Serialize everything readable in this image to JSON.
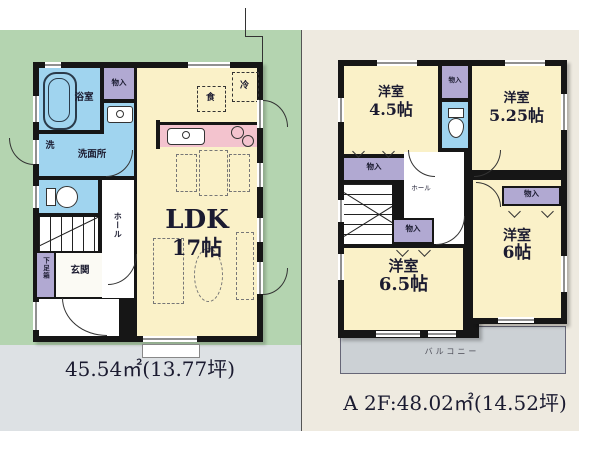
{
  "floor1": {
    "area_text": "45.54㎡(13.77坪)",
    "ldk_name": "LDK",
    "ldk_size": "17帖",
    "labels": {
      "bathroom": "浴室",
      "storage": "物入",
      "washer": "洗",
      "washroom": "洗面所",
      "shoe_cabinet": "下足箱",
      "entrance": "玄関",
      "hall": "ホール",
      "fridge": "冷",
      "cupboard": "食"
    }
  },
  "floor2": {
    "area_text": "A 2F:48.02㎡(14.52坪)",
    "labels": {
      "storage": "物入",
      "hall": "ホール",
      "balcony": "バルコニー"
    },
    "rooms": [
      {
        "name": "洋室",
        "size": "4.5帖"
      },
      {
        "name": "洋室",
        "size": "5.25帖"
      },
      {
        "name": "洋室",
        "size": "6.5帖"
      },
      {
        "name": "洋室",
        "size": "6帖"
      }
    ]
  },
  "colors": {
    "site_green": "#b4d4b0",
    "road_gray": "#dde1e4",
    "panel_cream": "#eeeae0",
    "room_cream": "#faf1c8",
    "wet_blue": "#a0d4ef",
    "closet_purple": "#b1a9d2",
    "kitchen_pink": "#f3c3ce",
    "balcony_gray": "#ccd1d5",
    "wall": "#161616"
  }
}
